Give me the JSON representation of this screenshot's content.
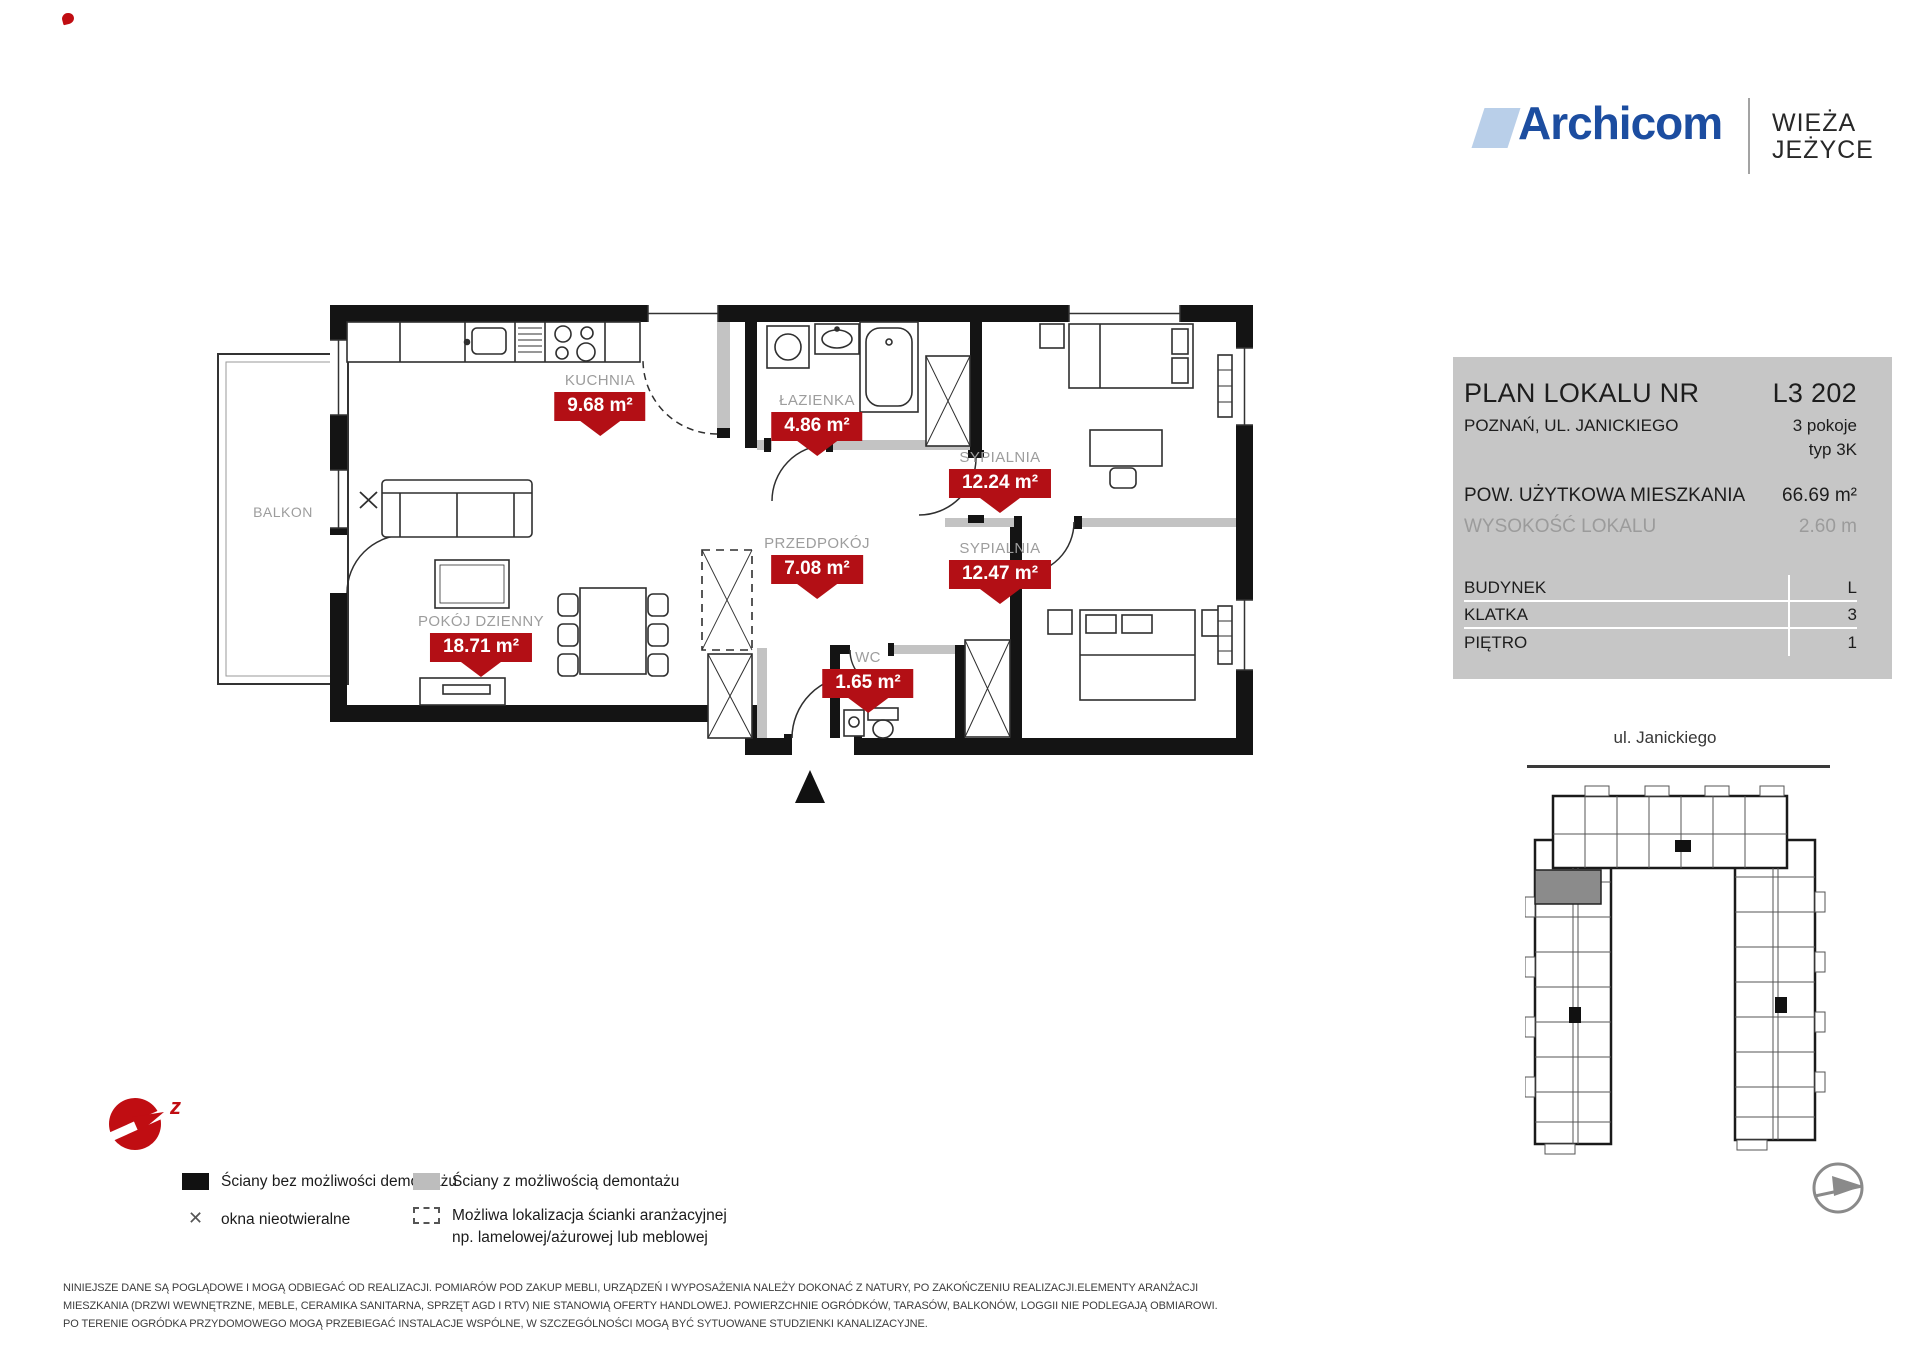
{
  "brand": {
    "logo_text": "Archicom",
    "project_line1": "WIEŻA",
    "project_line2": "JEŻYCE",
    "logo_color": "#1c4da0",
    "logo_mark_color": "#b9cfe9"
  },
  "info_panel": {
    "title_label": "PLAN LOKALU NR",
    "unit_number": "L3 202",
    "address": "POZNAŃ, UL. JANICKIEGO",
    "rooms": "3 pokoje",
    "type": "typ 3K",
    "area_label": "POW. UŻYTKOWA MIESZKANIA",
    "area_value": "66.69 m²",
    "height_label": "WYSOKOŚĆ LOKALU",
    "height_value": "2.60 m",
    "panel_bg": "#c6c6c6",
    "table": [
      {
        "label": "BUDYNEK",
        "value": "L"
      },
      {
        "label": "KLATKA",
        "value": "3"
      },
      {
        "label": "PIĘTRO",
        "value": "1"
      }
    ]
  },
  "floor_plan": {
    "badge_color": "#b30f15",
    "balcony_label": "BALKON",
    "rooms": [
      {
        "name": "KUCHNIA",
        "area": "9.68 m²"
      },
      {
        "name": "ŁAZIENKA",
        "area": "4.86 m²"
      },
      {
        "name": "SYPIALNIA",
        "area": "12.24 m²"
      },
      {
        "name": "PRZEDPOKÓJ",
        "area": "7.08 m²"
      },
      {
        "name": "SYPIALNIA",
        "area": "12.47 m²"
      },
      {
        "name": "POKÓJ DZIENNY",
        "area": "18.71 m²"
      },
      {
        "name": "WC",
        "area": "1.65 m²"
      }
    ]
  },
  "site_plan": {
    "street_label": "ul. Janickiego",
    "highlight_color": "#8b8b8b"
  },
  "compass": {
    "direction_letter": "z"
  },
  "legend": [
    {
      "symbol": "solid-black",
      "label": "Ściany bez możliwości demontażu"
    },
    {
      "symbol": "solid-gray",
      "label": "Ściany z możliwością demontażu"
    },
    {
      "symbol": "x-mark",
      "label": "okna nieotwieralne"
    },
    {
      "symbol": "dashed-box",
      "line1": "Możliwa lokalizacja ścianki aranżacyjnej",
      "line2": "np. lamelowej/ażurowej lub meblowej"
    }
  ],
  "disclaimer": {
    "text": "NINIEJSZE DANE SĄ POGLĄDOWE I MOGĄ ODBIEGAĆ OD REALIZACJI. POMIARÓW POD ZAKUP MEBLI, URZĄDZEŃ I WYPOSAŻENIA NALEŻY DOKONAĆ Z NATURY, PO ZAKOŃCZENIU REALIZACJI.ELEMENTY ARANŻACJI MIESZKANIA (DRZWI WEWNĘTRZNE, MEBLE, CERAMIKA SANITARNA, SPRZĘT AGD I RTV) NIE STANOWIĄ OFERTY HANDLOWEJ. POWIERZCHNIE OGRÓDKÓW, TARASÓW, BALKONÓW, LOGGII NIE PODLEGAJĄ OBMIAROWI. PO TERENIE OGRÓDKA PRZYDOMOWEGO MOGĄ PRZEBIEGAĆ INSTALACJE WSPÓLNE,  W SZCZEGÓLNOŚCI MOGĄ BYĆ SYTUOWANE STUDZIENKI KANALIZACYJNE."
  }
}
